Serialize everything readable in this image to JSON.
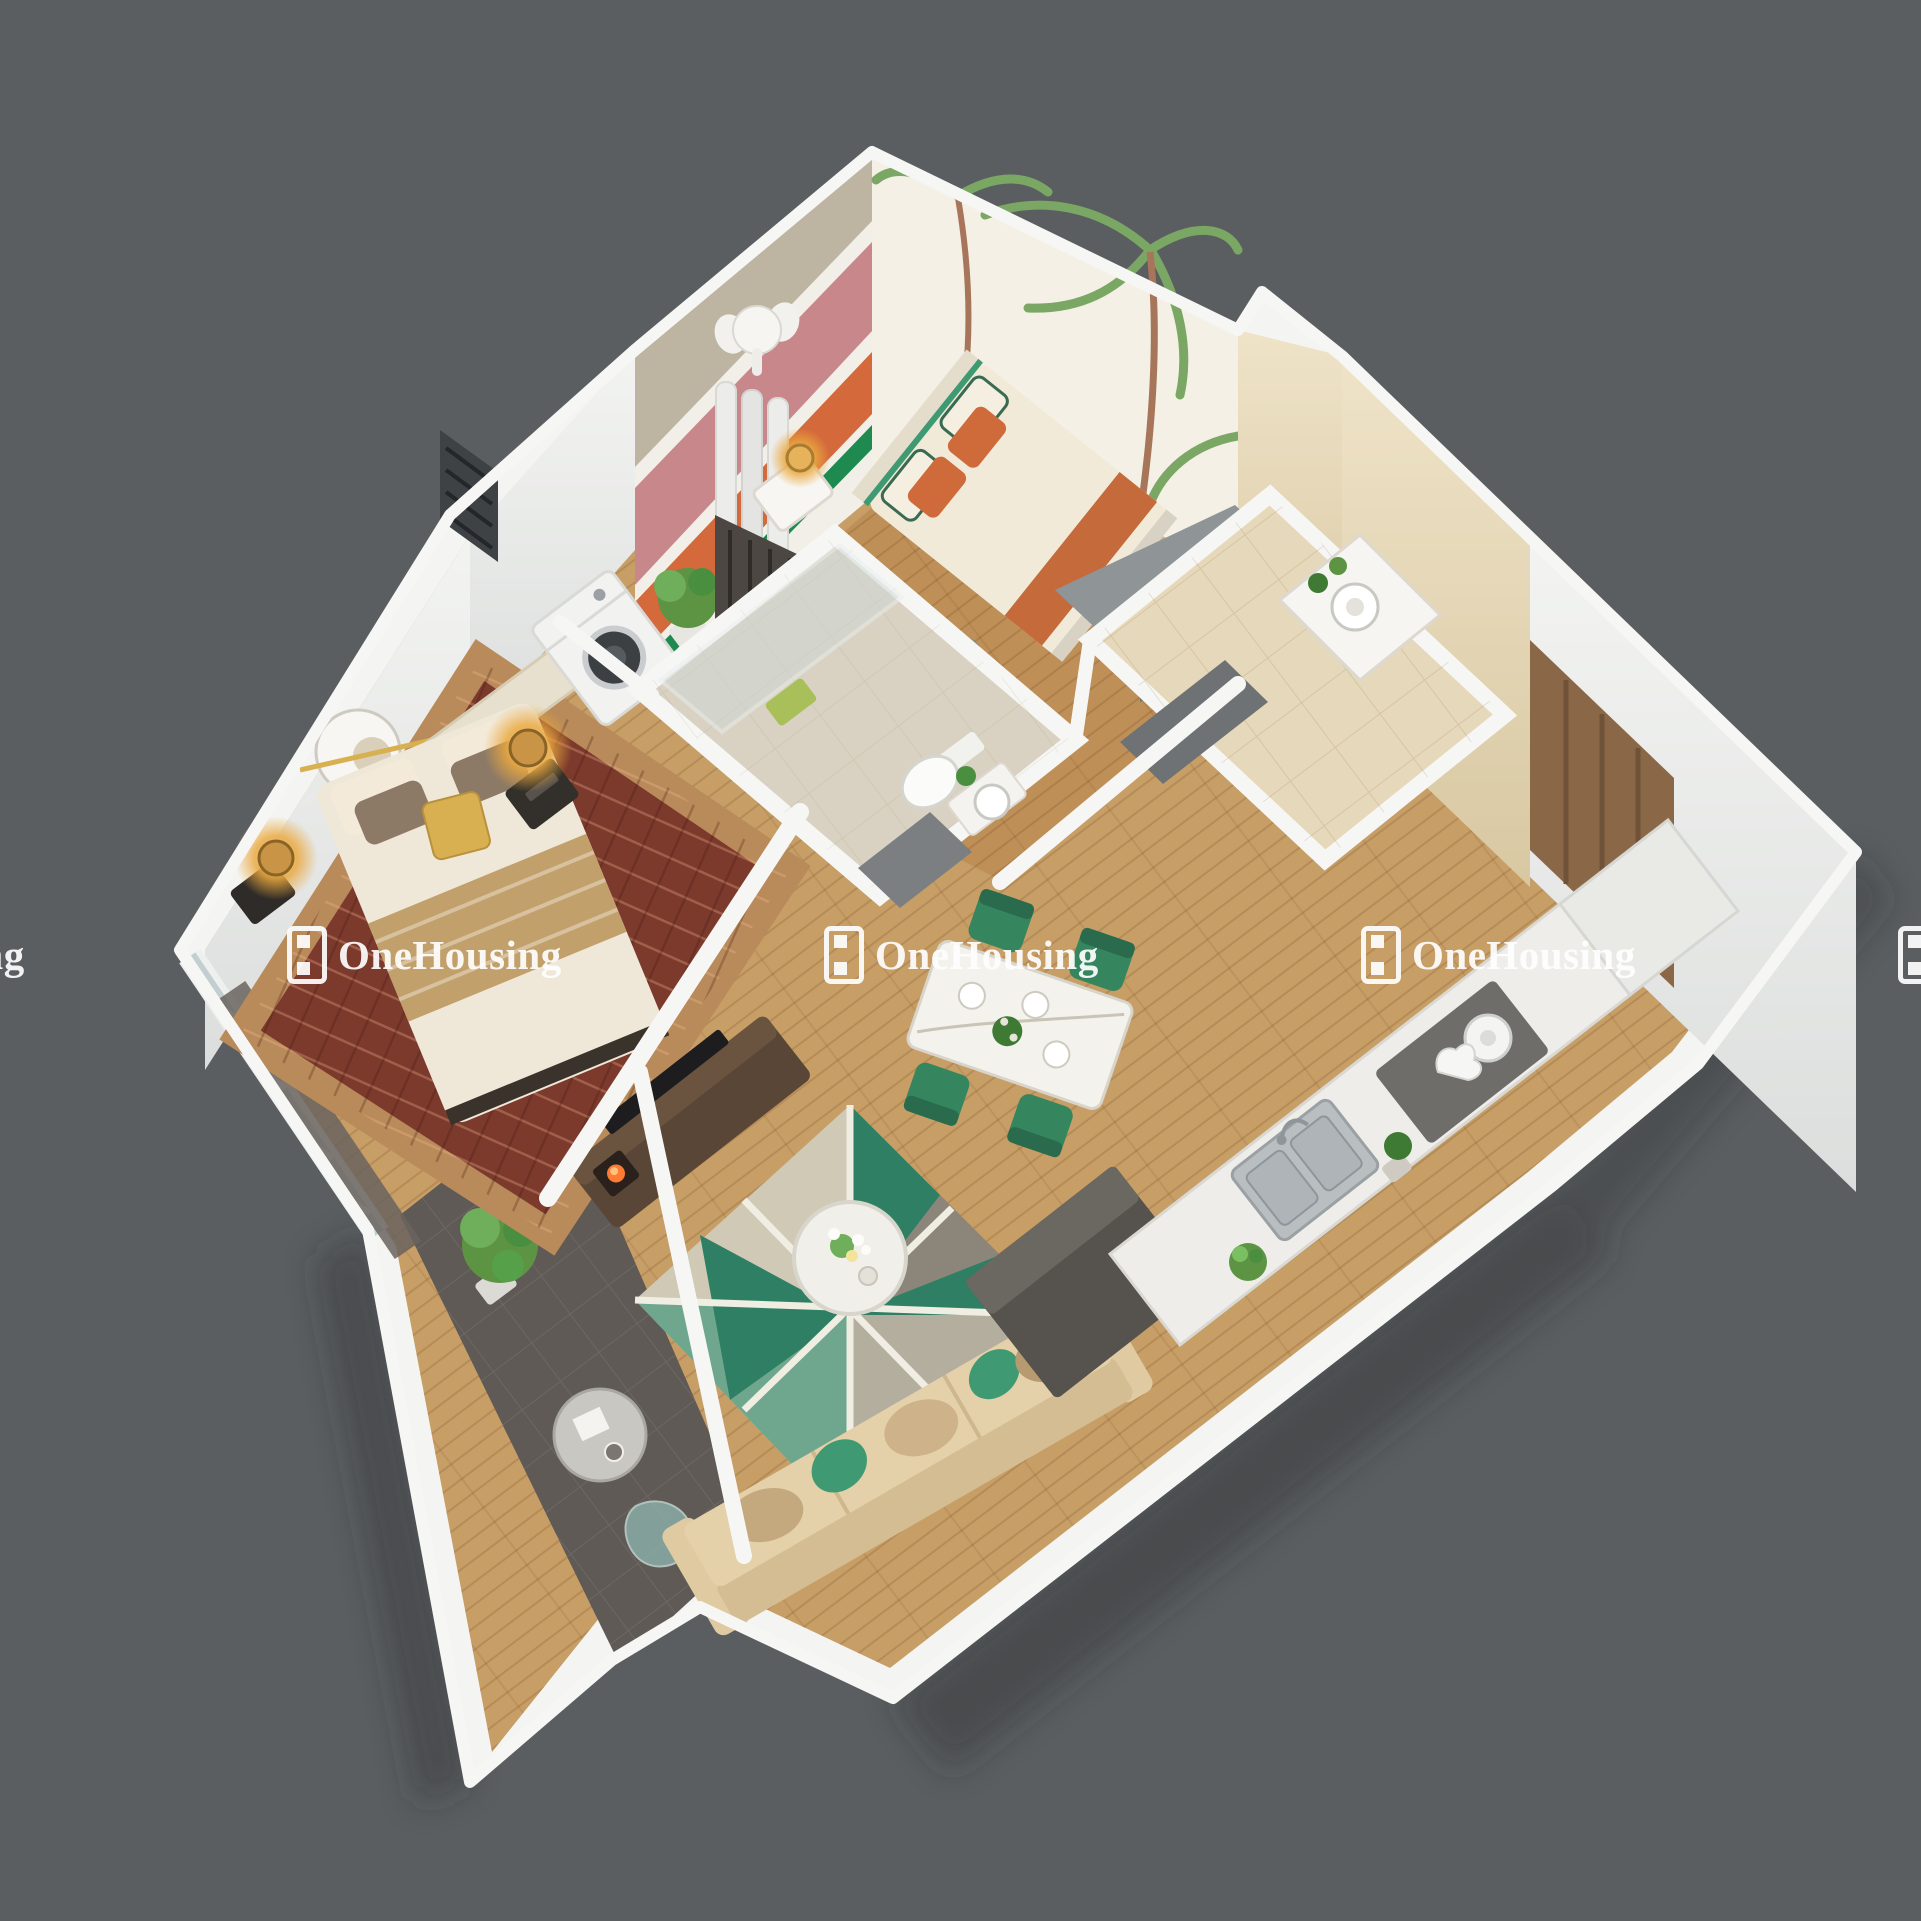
{
  "watermark": {
    "text": "OneHousing",
    "logo": "door-frame-icon",
    "color": "#ffffff",
    "opacity": 0.92,
    "instances": 5
  },
  "palette": {
    "background": "#5a5e61",
    "wall_top": "#f6f7f5",
    "wall_face": "#eceeec",
    "wood": "#c79e66",
    "wood_dark": "#bf8f58",
    "master_floor": "#7c3a2d",
    "wood_trim": "#b98a5a",
    "balcony_floor": "#5f5a55",
    "rug_base": "#cfc9b6",
    "rug_green": "#2e7f63",
    "rug_green_light": "#6fa78e",
    "rug_gray": "#b4ae9e",
    "sofa": "#e4d0a9",
    "pillow_tan": "#c4a97e",
    "pillow_green": "#3f9a74",
    "chair_green": "#35855f",
    "table_white": "#f4f2ec",
    "tile_beige": "#e6d8ba",
    "tile_wall": "#e9dcc0",
    "counter": "#eeede9",
    "steel": "#b9bec1",
    "dark_cabinet": "#56534e",
    "gray_block": "#8f9496",
    "door_brown": "#8a6847",
    "curtain": "#6a645e",
    "glass": "#b9c6c9",
    "plant_green": "#5d9444",
    "mural_taupe": "#bdb4a2",
    "mural_pink": "#c8878b",
    "mural_orange": "#d4693c",
    "mural_green": "#1e8a50",
    "palm_green": "#7aa763",
    "palm_trunk": "#a7765a",
    "gold_pillow": "#d8b051",
    "tv_black": "#1d1d1f",
    "ember": "#ff7a33",
    "duvet": "#efe7d8",
    "blanket_tan": "#c2a06c",
    "bed2_runner": "#c56a3a"
  }
}
